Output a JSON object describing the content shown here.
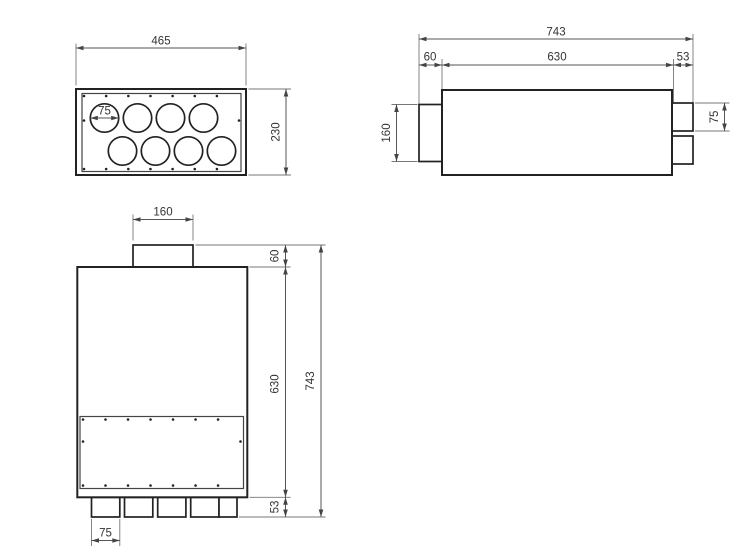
{
  "colors": {
    "background": "#ffffff",
    "object_line": "#222222",
    "dimension_line": "#555555",
    "label_text": "#333333"
  },
  "views": {
    "top": {
      "width": "465",
      "height": "230",
      "hole_diameter": "75"
    },
    "side": {
      "total_length": "743",
      "left_collar": "60",
      "body_length": "630",
      "right_collar": "53",
      "inlet_height": "160",
      "spigot_height": "75"
    },
    "front": {
      "inlet_width": "160",
      "collar_height": "60",
      "body_height": "630",
      "total_height": "743",
      "spigot_length": "53",
      "spigot_width": "75"
    }
  }
}
